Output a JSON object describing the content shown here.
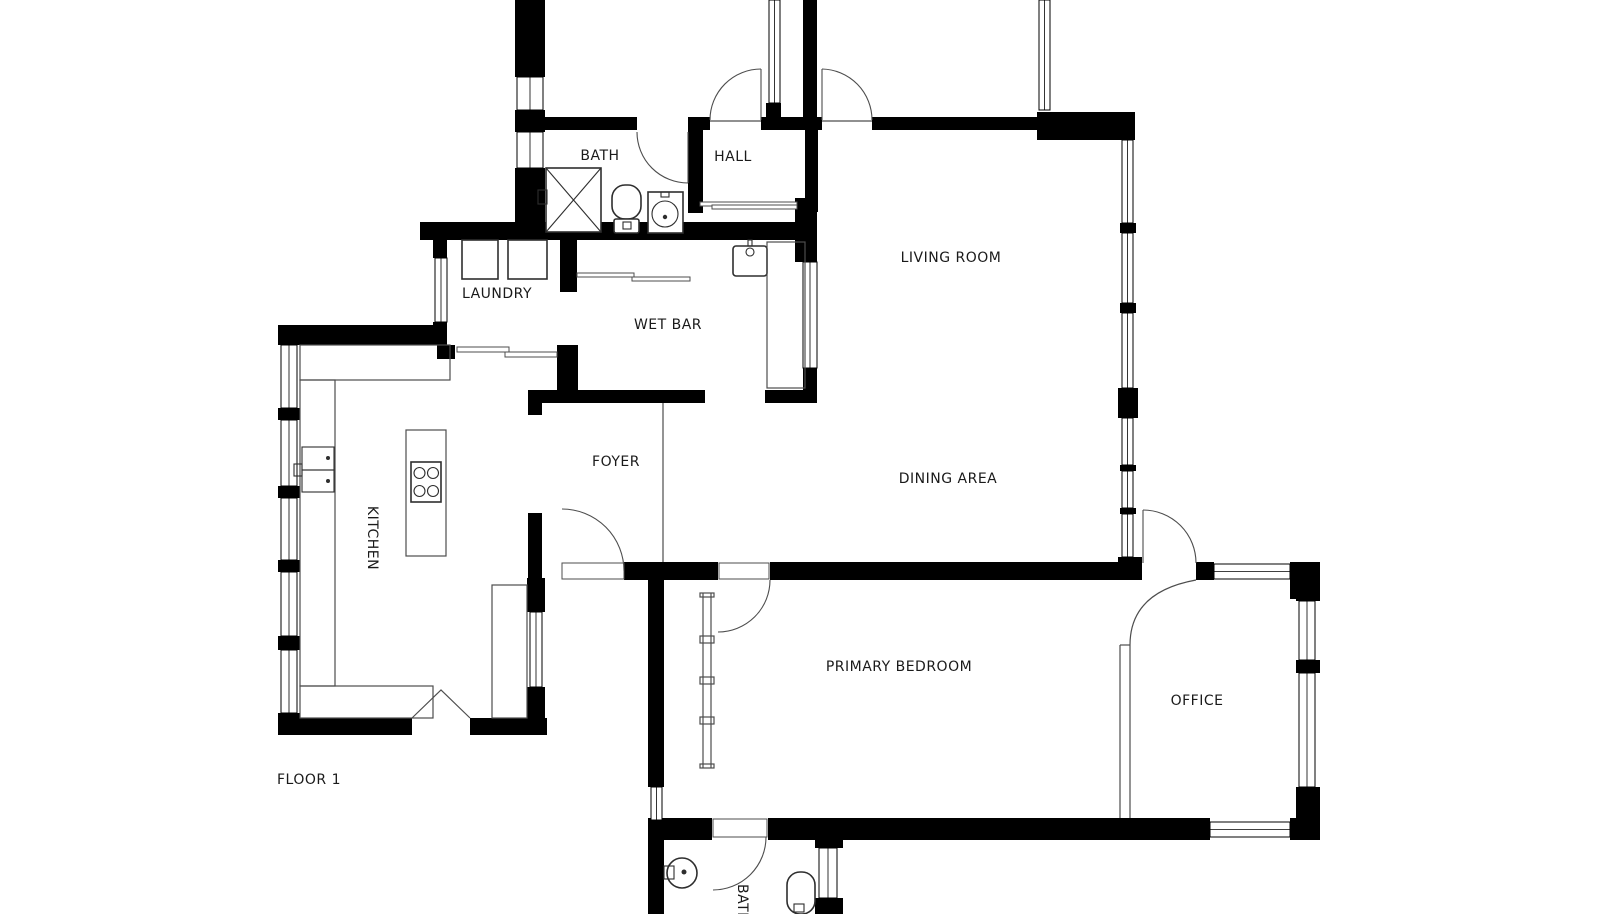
{
  "floor_label": "FLOOR 1",
  "rooms": {
    "bath": {
      "label": "BATH"
    },
    "hall": {
      "label": "HALL"
    },
    "living_room": {
      "label": "LIVING ROOM"
    },
    "laundry": {
      "label": "LAUNDRY"
    },
    "wet_bar": {
      "label": "WET BAR"
    },
    "foyer": {
      "label": "FOYER"
    },
    "dining_area": {
      "label": "DINING AREA"
    },
    "kitchen": {
      "label": "KITCHEN"
    },
    "primary_bedroom": {
      "label": "PRIMARY BEDROOM"
    },
    "office": {
      "label": "OFFICE"
    },
    "bath_lower": {
      "label": "BATH"
    }
  },
  "colors": {
    "wall": "#000000",
    "background": "#ffffff",
    "line": "#4d4d4d",
    "text": "#1a1a1a",
    "fixture": "#2e2e2e"
  },
  "fixtures": [
    "shower-icon",
    "toilet-icon",
    "bath-sink-icon",
    "washer-icon",
    "dryer-icon",
    "wet-bar-sink-icon",
    "kitchen-sink-icon",
    "stove-icon",
    "kitchen-island",
    "round-sink-icon"
  ]
}
